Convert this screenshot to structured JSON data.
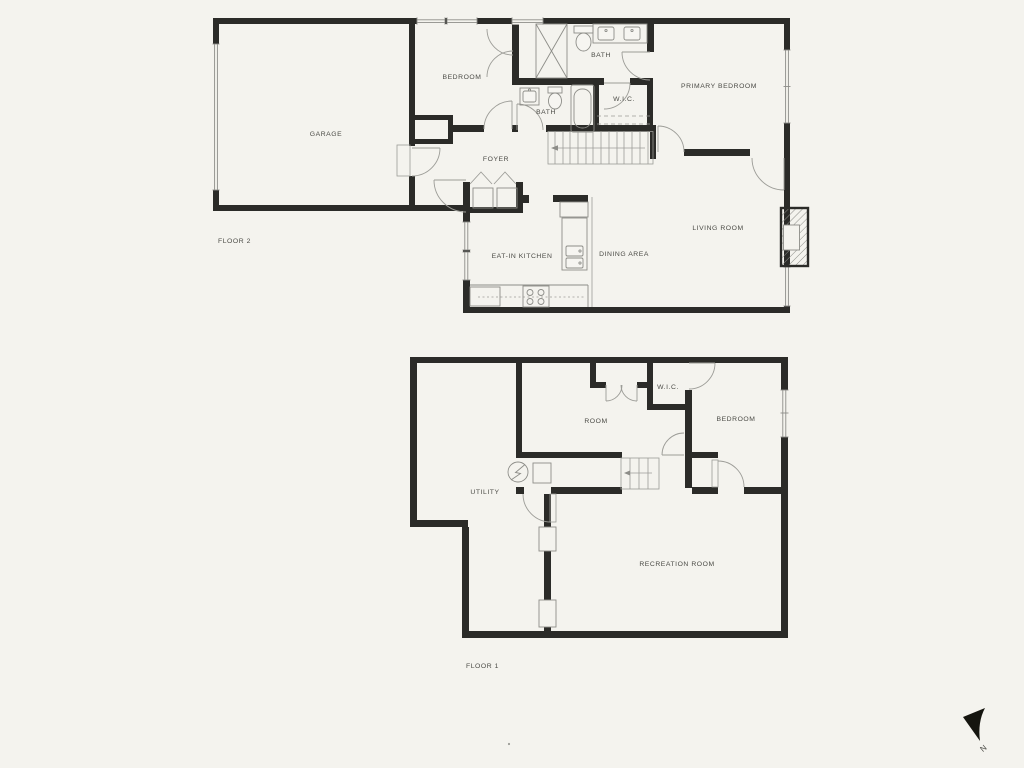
{
  "title": "Two-floor residence floor plan",
  "colors": {
    "background": "#f4f3ee",
    "walls": "#2b2b28",
    "thin_lines": "#8d8d88",
    "text": "#4b4b46"
  },
  "floor2": {
    "label": "FLOOR 2",
    "rooms": {
      "garage": "GARAGE",
      "bedroom": "BEDROOM",
      "bath_top": "BATH",
      "bath_mid": "BATH",
      "wic": "W.I.C.",
      "primary_bedroom": "PRIMARY BEDROOM",
      "foyer": "FOYER",
      "kitchen": "EAT-IN KITCHEN",
      "dining": "DINING AREA",
      "living": "LIVING ROOM"
    }
  },
  "floor1": {
    "label": "FLOOR 1",
    "rooms": {
      "room": "ROOM",
      "wic": "W.I.C.",
      "bedroom": "BEDROOM",
      "utility": "UTILITY",
      "recreation": "RECREATION ROOM"
    }
  },
  "compass": {
    "label": "N"
  }
}
